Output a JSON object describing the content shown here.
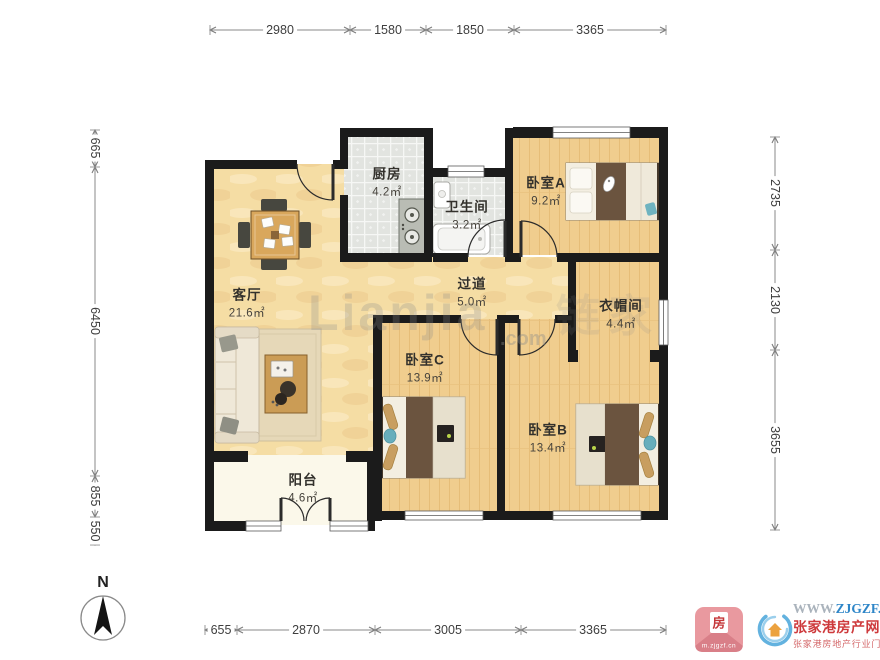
{
  "plan": {
    "rooms": [
      {
        "name": "厨房",
        "area": "4.2㎡"
      },
      {
        "name": "卫生间",
        "area": "3.2㎡"
      },
      {
        "name": "卧室A",
        "area": "9.2㎡"
      },
      {
        "name": "客厅",
        "area": "21.6㎡"
      },
      {
        "name": "过道",
        "area": "5.0㎡"
      },
      {
        "name": "衣帽间",
        "area": "4.4㎡"
      },
      {
        "name": "卧室C",
        "area": "13.9㎡"
      },
      {
        "name": "卧室B",
        "area": "13.4㎡"
      },
      {
        "name": "阳台",
        "area": "4.6㎡"
      }
    ],
    "dimensions": {
      "top": [
        "2980",
        "1580",
        "1850",
        "3365"
      ],
      "bottom": [
        "655",
        "2870",
        "3005",
        "3365"
      ],
      "left": [
        "665",
        "6450",
        "855",
        "550"
      ],
      "right": [
        "2735",
        "2130",
        "3655"
      ]
    },
    "compass_label": "N"
  },
  "watermark": {
    "latin": "Lianjia",
    "cn": "链家",
    "tld": ".com"
  },
  "footer": {
    "app_badge": {
      "char": "房",
      "url": "m.zjgzf.cn"
    },
    "site": {
      "url_prefix": "WWW.",
      "url_main": "ZJGZF.CN",
      "name": "张家港房产网",
      "tagline": "张家港房地产行业门户"
    }
  },
  "colors": {
    "wall": "#1b1b1b",
    "wood_bedroom": "#f0cd8e",
    "wood_living": "#f5dda4",
    "tile": "#e2e4e0",
    "balcony_floor": "#fbf8ea",
    "accent_red": "#ce3a3c",
    "accent_blue": "#2e86c8"
  }
}
